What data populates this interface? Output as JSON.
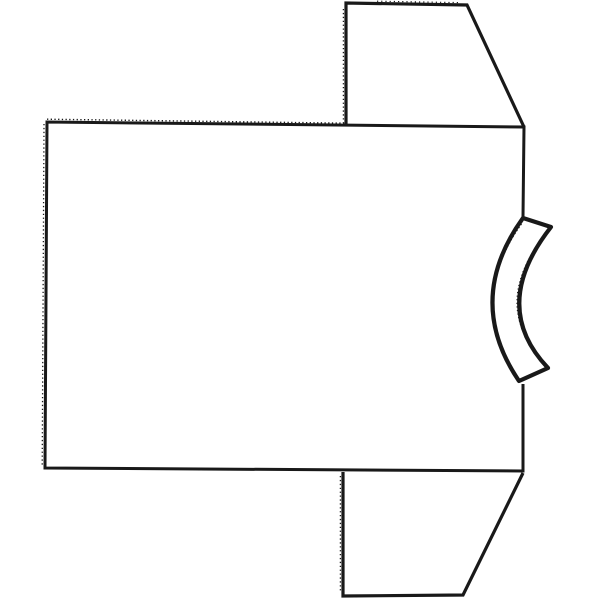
{
  "canvas": {
    "width": 600,
    "height": 600,
    "background": "#ffffff",
    "ink": "#191919"
  },
  "diagram": {
    "pieces": [
      {
        "name": "body-panel-outline",
        "d": "M 523,217 L 524,127 L 47,122 L 45,468 L 523,471 L 523,384",
        "width": 3,
        "fill": "none",
        "linejoin": "miter"
      },
      {
        "name": "sleeve-top-outline",
        "d": "M 346,126 L 346,3 L 467,5 L 524,127",
        "width": 3.2,
        "fill": "none",
        "linejoin": "miter"
      },
      {
        "name": "sleeve-bottom-outline",
        "d": "M 343,472 L 343,596 L 463,595 L 523,473",
        "width": 3.2,
        "fill": "none",
        "linejoin": "miter"
      },
      {
        "name": "neckband-outline",
        "d": "M 523,218 Q 464,300 519,381 L 548,368 Q 489,306 551,227 Z",
        "width": 4.2,
        "fill": "#ffffff",
        "linejoin": "round"
      },
      {
        "name": "body-top-serration-texture",
        "d": "M 47,119.2 L 346,123.2",
        "width": 1.4,
        "fill": "none",
        "dash": "1.3,2.4"
      },
      {
        "name": "body-left-fringe-texture",
        "d": "M 44,124 L 42.2,466",
        "width": 1.3,
        "fill": "none",
        "dash": "1.3,2.6"
      },
      {
        "name": "sleeve-top-left-fringe-texture",
        "d": "M 343.4,9 L 343.4,123",
        "width": 1.3,
        "fill": "none",
        "dash": "1.3,2.6"
      },
      {
        "name": "sleeve-bottom-left-fringe-texture",
        "d": "M 340.4,476 L 340.4,593",
        "width": 1.3,
        "fill": "none",
        "dash": "1.3,2.6"
      },
      {
        "name": "sleeve-top-edge-ticks-texture",
        "d": "M 377,1.2 L 458,2.6",
        "width": 1.2,
        "fill": "none",
        "dash": "1.2,3"
      },
      {
        "name": "neckband-outer-fringe-texture",
        "d": "M 521.5,224 Q 467,300 517,376",
        "width": 1.2,
        "fill": "none",
        "dash": "1.2,2.4"
      },
      {
        "name": "neckband-inner-fringe-texture",
        "d": "M 546,364 Q 487,305 548,231",
        "width": 1.2,
        "fill": "none",
        "dash": "1.2,2.4"
      }
    ]
  }
}
